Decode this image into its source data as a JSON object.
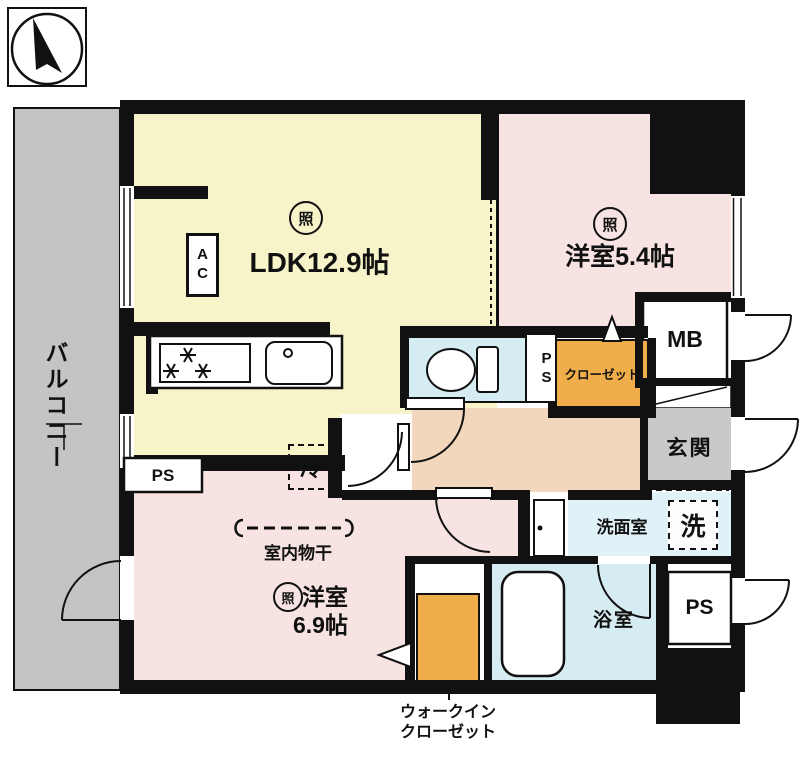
{
  "colors": {
    "wall": "#111111",
    "balcony": "#c4c4c4",
    "ldk": "#f8f4c9",
    "pink_room": "#f7e3e2",
    "corridor": "#f3d7bd",
    "wet_blue": "#d6ecf3",
    "washroom_blue": "#e0f2f7",
    "closet_orange": "#efae49",
    "entrance_gray": "#c9c9c9"
  },
  "rooms": {
    "balcony": {
      "label": "バルコニー"
    },
    "ldk": {
      "label": "LDK12.9帖",
      "ac": "AC",
      "light": "照"
    },
    "western_room_5_4": {
      "label": "洋室5.4帖",
      "light": "照"
    },
    "western_room_6_9": {
      "name": "洋室",
      "size": "6.9帖",
      "light": "照",
      "laundry": "室内物干"
    },
    "closet": {
      "label": "クローゼット"
    },
    "walk_in_closet": {
      "line1": "ウォークイン",
      "line2": "クローゼット"
    },
    "meter_box": {
      "label": "MB"
    },
    "entrance": {
      "label": "玄関"
    },
    "washroom": {
      "label": "洗面室",
      "washer": "洗"
    },
    "bathroom": {
      "label": "浴室"
    },
    "pipe_space_left": {
      "label": "PS"
    },
    "pipe_space_center": {
      "label": "PS"
    },
    "pipe_space_right": {
      "label": "PS"
    },
    "refrigerator": {
      "label": "冷"
    }
  }
}
